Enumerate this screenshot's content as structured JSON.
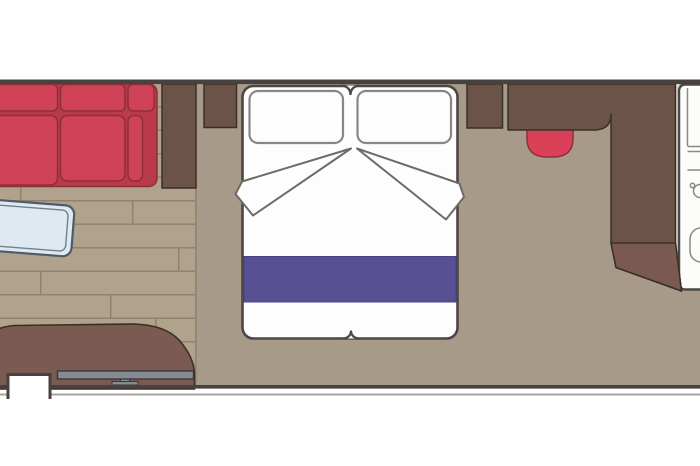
{
  "meta": {
    "title": "cabin-floor-plan",
    "description": "Top-down floor plan of a ship cabin: sofa, coffee table, double bed, nightstands, desk with stool, wardrobe, entry door, bathroom (cut off at right edge)",
    "text_content": []
  },
  "colors": {
    "page_bg": "#ffffff",
    "wall": "#474140",
    "wall_light": "#a8a29a",
    "floor": "#a89a88",
    "wood_base": "#b1a28c",
    "wood_line": "#8f8271",
    "furniture_dark": "#6b5347",
    "door_brown": "#7a5a50",
    "cabinet_brown": "#7b5a51",
    "outline_dark": "#3a2e28",
    "sofa_red": "#d04356",
    "sofa_dark": "#b83a4b",
    "sofa_seam": "#8e2f3c",
    "stool_red": "#da4058",
    "runner_purple": "#575093",
    "runner_edge": "#494384",
    "bed_fill": "#fdfdfe",
    "bed_border": "#4c4644",
    "pillow_border": "#8a8684",
    "fold_line": "#6e6a66",
    "table_fill": "#dfe9f2",
    "table_border": "#4e5c68",
    "tv_gray": "#878c93",
    "tv_outline": "#35393e",
    "bath_fill": "#fcfcfa",
    "bath_stroke": "#4c4a48",
    "bath_inner": "#8a8885",
    "gap_wall": "#e8e4db",
    "notch_fill": "#ffffff"
  },
  "items": [
    "sofa",
    "coffee-table",
    "wood-floor",
    "wardrobe-left",
    "nightstand-left",
    "bed",
    "pillows",
    "duvet-folds",
    "bed-runner",
    "nightstand-right",
    "desk",
    "stool",
    "wardrobe-right",
    "entry-door",
    "bathroom",
    "tv-cabinet",
    "tv",
    "top-wall",
    "bottom-wall",
    "wall-notch"
  ]
}
